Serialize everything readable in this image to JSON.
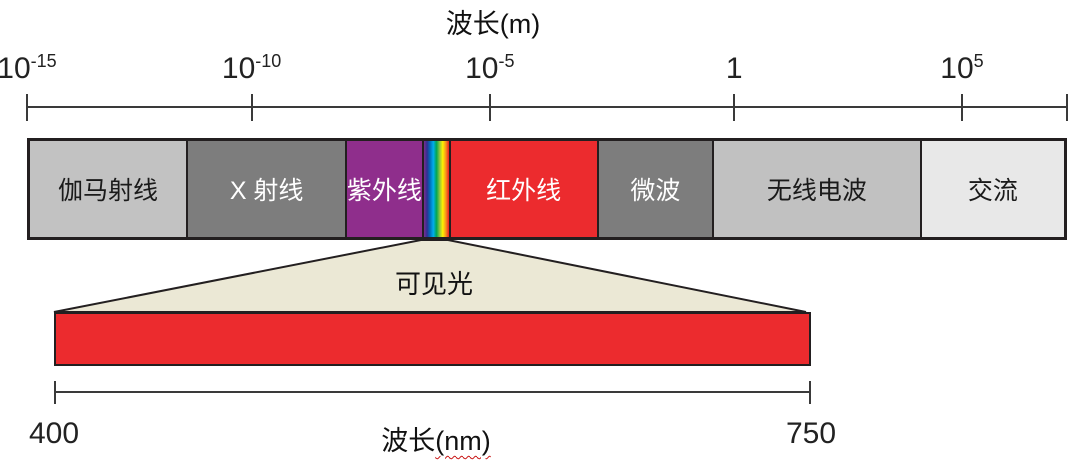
{
  "title_m": "波长(m)",
  "top_axis": {
    "scale": "log10 meters",
    "ticks": [
      {
        "base": "10",
        "exp": "-15"
      },
      {
        "base": "10",
        "exp": "-10"
      },
      {
        "base": "10",
        "exp": "-5"
      },
      {
        "base": "1",
        "exp": ""
      },
      {
        "base": "10",
        "exp": "5"
      }
    ]
  },
  "spectrum": {
    "segments": [
      {
        "label": "伽马射线",
        "color": "#c2c2c2",
        "text_color": "#1a1a1a"
      },
      {
        "label": "X 射线",
        "color": "#7d7d7d",
        "text_color": "#ffffff"
      },
      {
        "label": "紫外线",
        "color": "#8f2e8c",
        "text_color": "#ffffff"
      },
      {
        "label": "红外线",
        "color": "#ec2b2e",
        "text_color": "#ffffff"
      },
      {
        "label": "微波",
        "color": "#7d7d7d",
        "text_color": "#ffffff"
      },
      {
        "label": "无线电波",
        "color": "#c1c1c1",
        "text_color": "#1a1a1a"
      },
      {
        "label": "交流",
        "color": "#e8e8e8",
        "text_color": "#1a1a1a"
      }
    ],
    "visible_strip": {
      "gradient": [
        "#7a2e8e",
        "#2e3192",
        "#0072bc",
        "#00aeef",
        "#00a651",
        "#8dc63f",
        "#fff200",
        "#f7941d",
        "#ed1c24"
      ]
    }
  },
  "visible_light": {
    "label": "可见光",
    "funnel_color": "#ebe8d5",
    "bar_color": "#ec2b2e",
    "outline_color": "#231f20",
    "axis_min": "400",
    "axis_max": "750",
    "axis_title_prefix": "波长",
    "axis_title_unit": "(nm)"
  }
}
